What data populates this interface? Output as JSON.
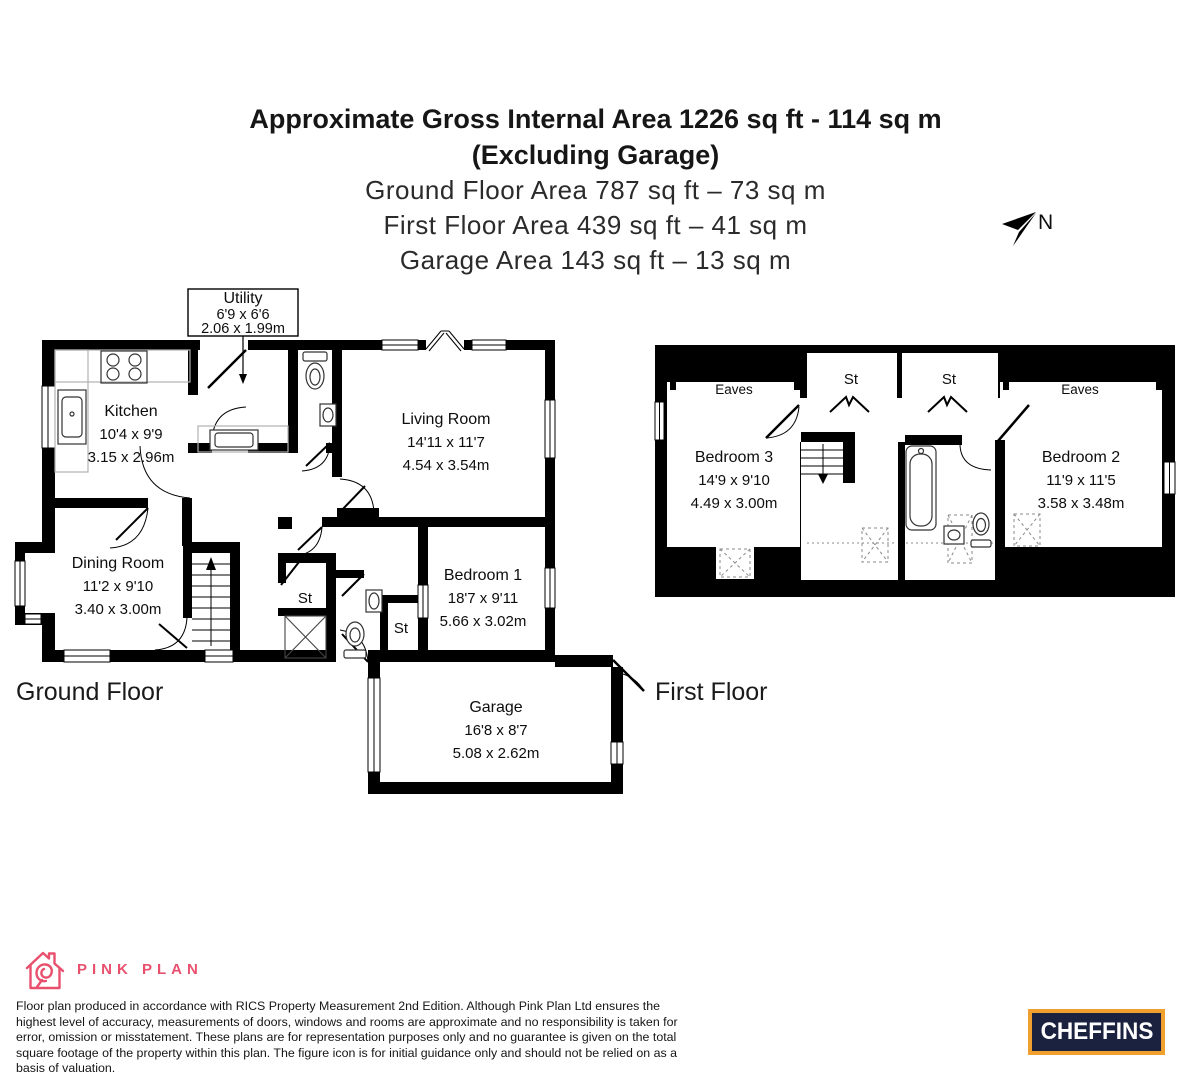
{
  "header": {
    "title_line1": "Approximate Gross Internal Area 1226 sq ft - 114 sq m",
    "title_line2": "(Excluding Garage)",
    "ground_line": "Ground Floor Area 787 sq ft – 73 sq m",
    "first_line": "First Floor Area 439 sq ft – 41 sq m",
    "garage_line": "Garage Area 143 sq ft – 13 sq m"
  },
  "compass": {
    "north_label": "N"
  },
  "floors": {
    "ground": {
      "caption": "Ground Floor",
      "rooms": {
        "utility": {
          "name": "Utility",
          "imperial": "6'9 x 6'6",
          "metric": "2.06 x 1.99m"
        },
        "kitchen": {
          "name": "Kitchen",
          "imperial": "10'4 x 9'9",
          "metric": "3.15 x 2.96m"
        },
        "living_room": {
          "name": "Living Room",
          "imperial": "14'11 x 11'7",
          "metric": "4.54 x 3.54m"
        },
        "dining_room": {
          "name": "Dining Room",
          "imperial": "11'2 x 9'10",
          "metric": "3.40 x 3.00m"
        },
        "bedroom_1": {
          "name": "Bedroom 1",
          "imperial": "18'7 x 9'11",
          "metric": "5.66 x 3.02m"
        },
        "garage": {
          "name": "Garage",
          "imperial": "16'8 x 8'7",
          "metric": "5.08 x 2.62m"
        },
        "store_1": {
          "name": "St"
        },
        "store_2": {
          "name": "St"
        }
      }
    },
    "first": {
      "caption": "First Floor",
      "rooms": {
        "bedroom_3": {
          "name": "Bedroom 3",
          "imperial": "14'9 x 9'10",
          "metric": "4.49 x 3.00m"
        },
        "bedroom_2": {
          "name": "Bedroom 2",
          "imperial": "11'9 x 11'5",
          "metric": "3.58 x 3.48m"
        },
        "eaves_left": {
          "name": "Eaves"
        },
        "eaves_right": {
          "name": "Eaves"
        },
        "store_left": {
          "name": "St"
        },
        "store_right": {
          "name": "St"
        }
      }
    }
  },
  "footer": {
    "logo_text": "PINK PLAN",
    "disclaimer": "Floor plan produced in accordance with RICS Property Measurement 2nd Edition. Although Pink Plan Ltd ensures the highest level of accuracy, measurements of doors, windows and rooms are approximate and no responsibility is taken for error, omission or misstatement. These plans are for representation purposes only and no guarantee is given on the total square footage of the property within this plan. The figure icon is for initial guidance only and should not be relied on as a basis of valuation.",
    "brand": "CHEFFINS"
  },
  "colors": {
    "pink": "#E8506E",
    "navy": "#1B2240",
    "orange": "#EFA02E",
    "wall": "#000000"
  }
}
